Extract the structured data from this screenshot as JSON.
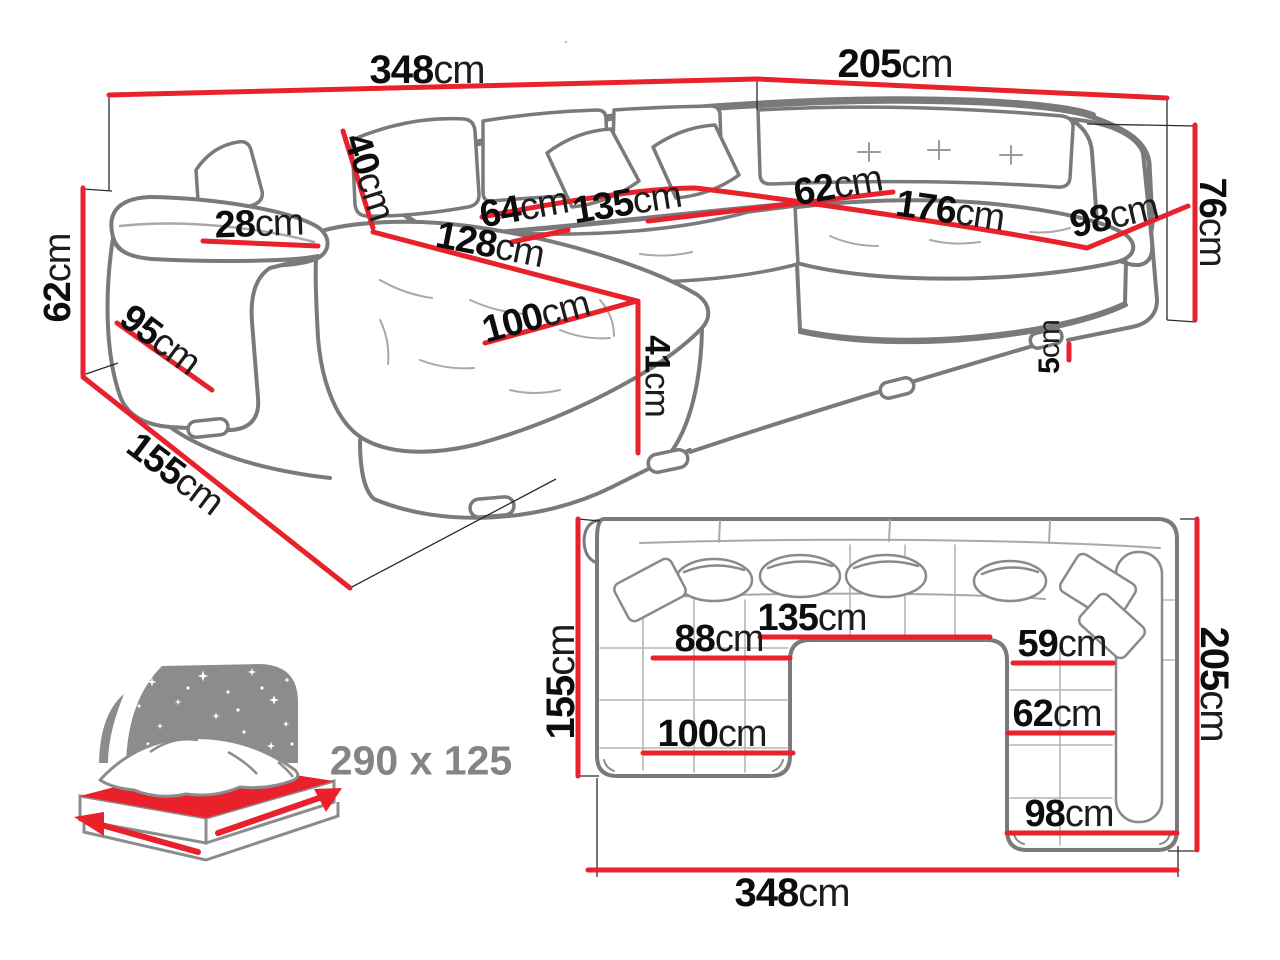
{
  "diagram": "sectional-sofa-dimension-spec",
  "colors": {
    "dimension_red": "#e8212b",
    "sofa_line_gray": "#7a7a7a",
    "detail_light_gray": "#a9a9a9",
    "label_black": "#111111",
    "bed_icon_gray": "#8c8c8c"
  },
  "perspective_view": {
    "dims": [
      {
        "name": "back-width",
        "value": "348",
        "unit": "cm"
      },
      {
        "name": "right-side-depth",
        "value": "205",
        "unit": "cm"
      },
      {
        "name": "back-cushion-height",
        "value": "40",
        "unit": "cm"
      },
      {
        "name": "armrest-width",
        "value": "28",
        "unit": "cm"
      },
      {
        "name": "seat-section-left",
        "value": "64",
        "unit": "cm"
      },
      {
        "name": "seat-section-middle",
        "value": "135",
        "unit": "cm"
      },
      {
        "name": "chaise-length",
        "value": "128",
        "unit": "cm"
      },
      {
        "name": "corner-seat-depth",
        "value": "62",
        "unit": "cm"
      },
      {
        "name": "right-seat-length",
        "value": "176",
        "unit": "cm"
      },
      {
        "name": "right-armrest-length",
        "value": "98",
        "unit": "cm"
      },
      {
        "name": "backrest-height",
        "value": "76",
        "unit": "cm"
      },
      {
        "name": "armrest-height",
        "value": "62",
        "unit": "cm"
      },
      {
        "name": "armrest-depth",
        "value": "95",
        "unit": "cm"
      },
      {
        "name": "total-depth-left",
        "value": "155",
        "unit": "cm"
      },
      {
        "name": "chaise-width",
        "value": "100",
        "unit": "cm"
      },
      {
        "name": "seat-height",
        "value": "41",
        "unit": "cm"
      },
      {
        "name": "leg-height",
        "value": "5",
        "unit": "cm"
      }
    ]
  },
  "top_view": {
    "dims": [
      {
        "name": "left-depth",
        "value": "155",
        "unit": "cm"
      },
      {
        "name": "right-depth",
        "value": "205",
        "unit": "cm"
      },
      {
        "name": "middle-seat-width",
        "value": "135",
        "unit": "cm"
      },
      {
        "name": "chaise-seat-width",
        "value": "88",
        "unit": "cm"
      },
      {
        "name": "right-seat-width",
        "value": "59",
        "unit": "cm"
      },
      {
        "name": "right-section-inner-width",
        "value": "62",
        "unit": "cm"
      },
      {
        "name": "chaise-foot-width",
        "value": "100",
        "unit": "cm"
      },
      {
        "name": "right-section-foot-width",
        "value": "98",
        "unit": "cm"
      },
      {
        "name": "total-width",
        "value": "348",
        "unit": "cm"
      }
    ]
  },
  "sleeping_area": {
    "icon": "sleeping-bed-icon",
    "size_label": "290 x 125"
  }
}
